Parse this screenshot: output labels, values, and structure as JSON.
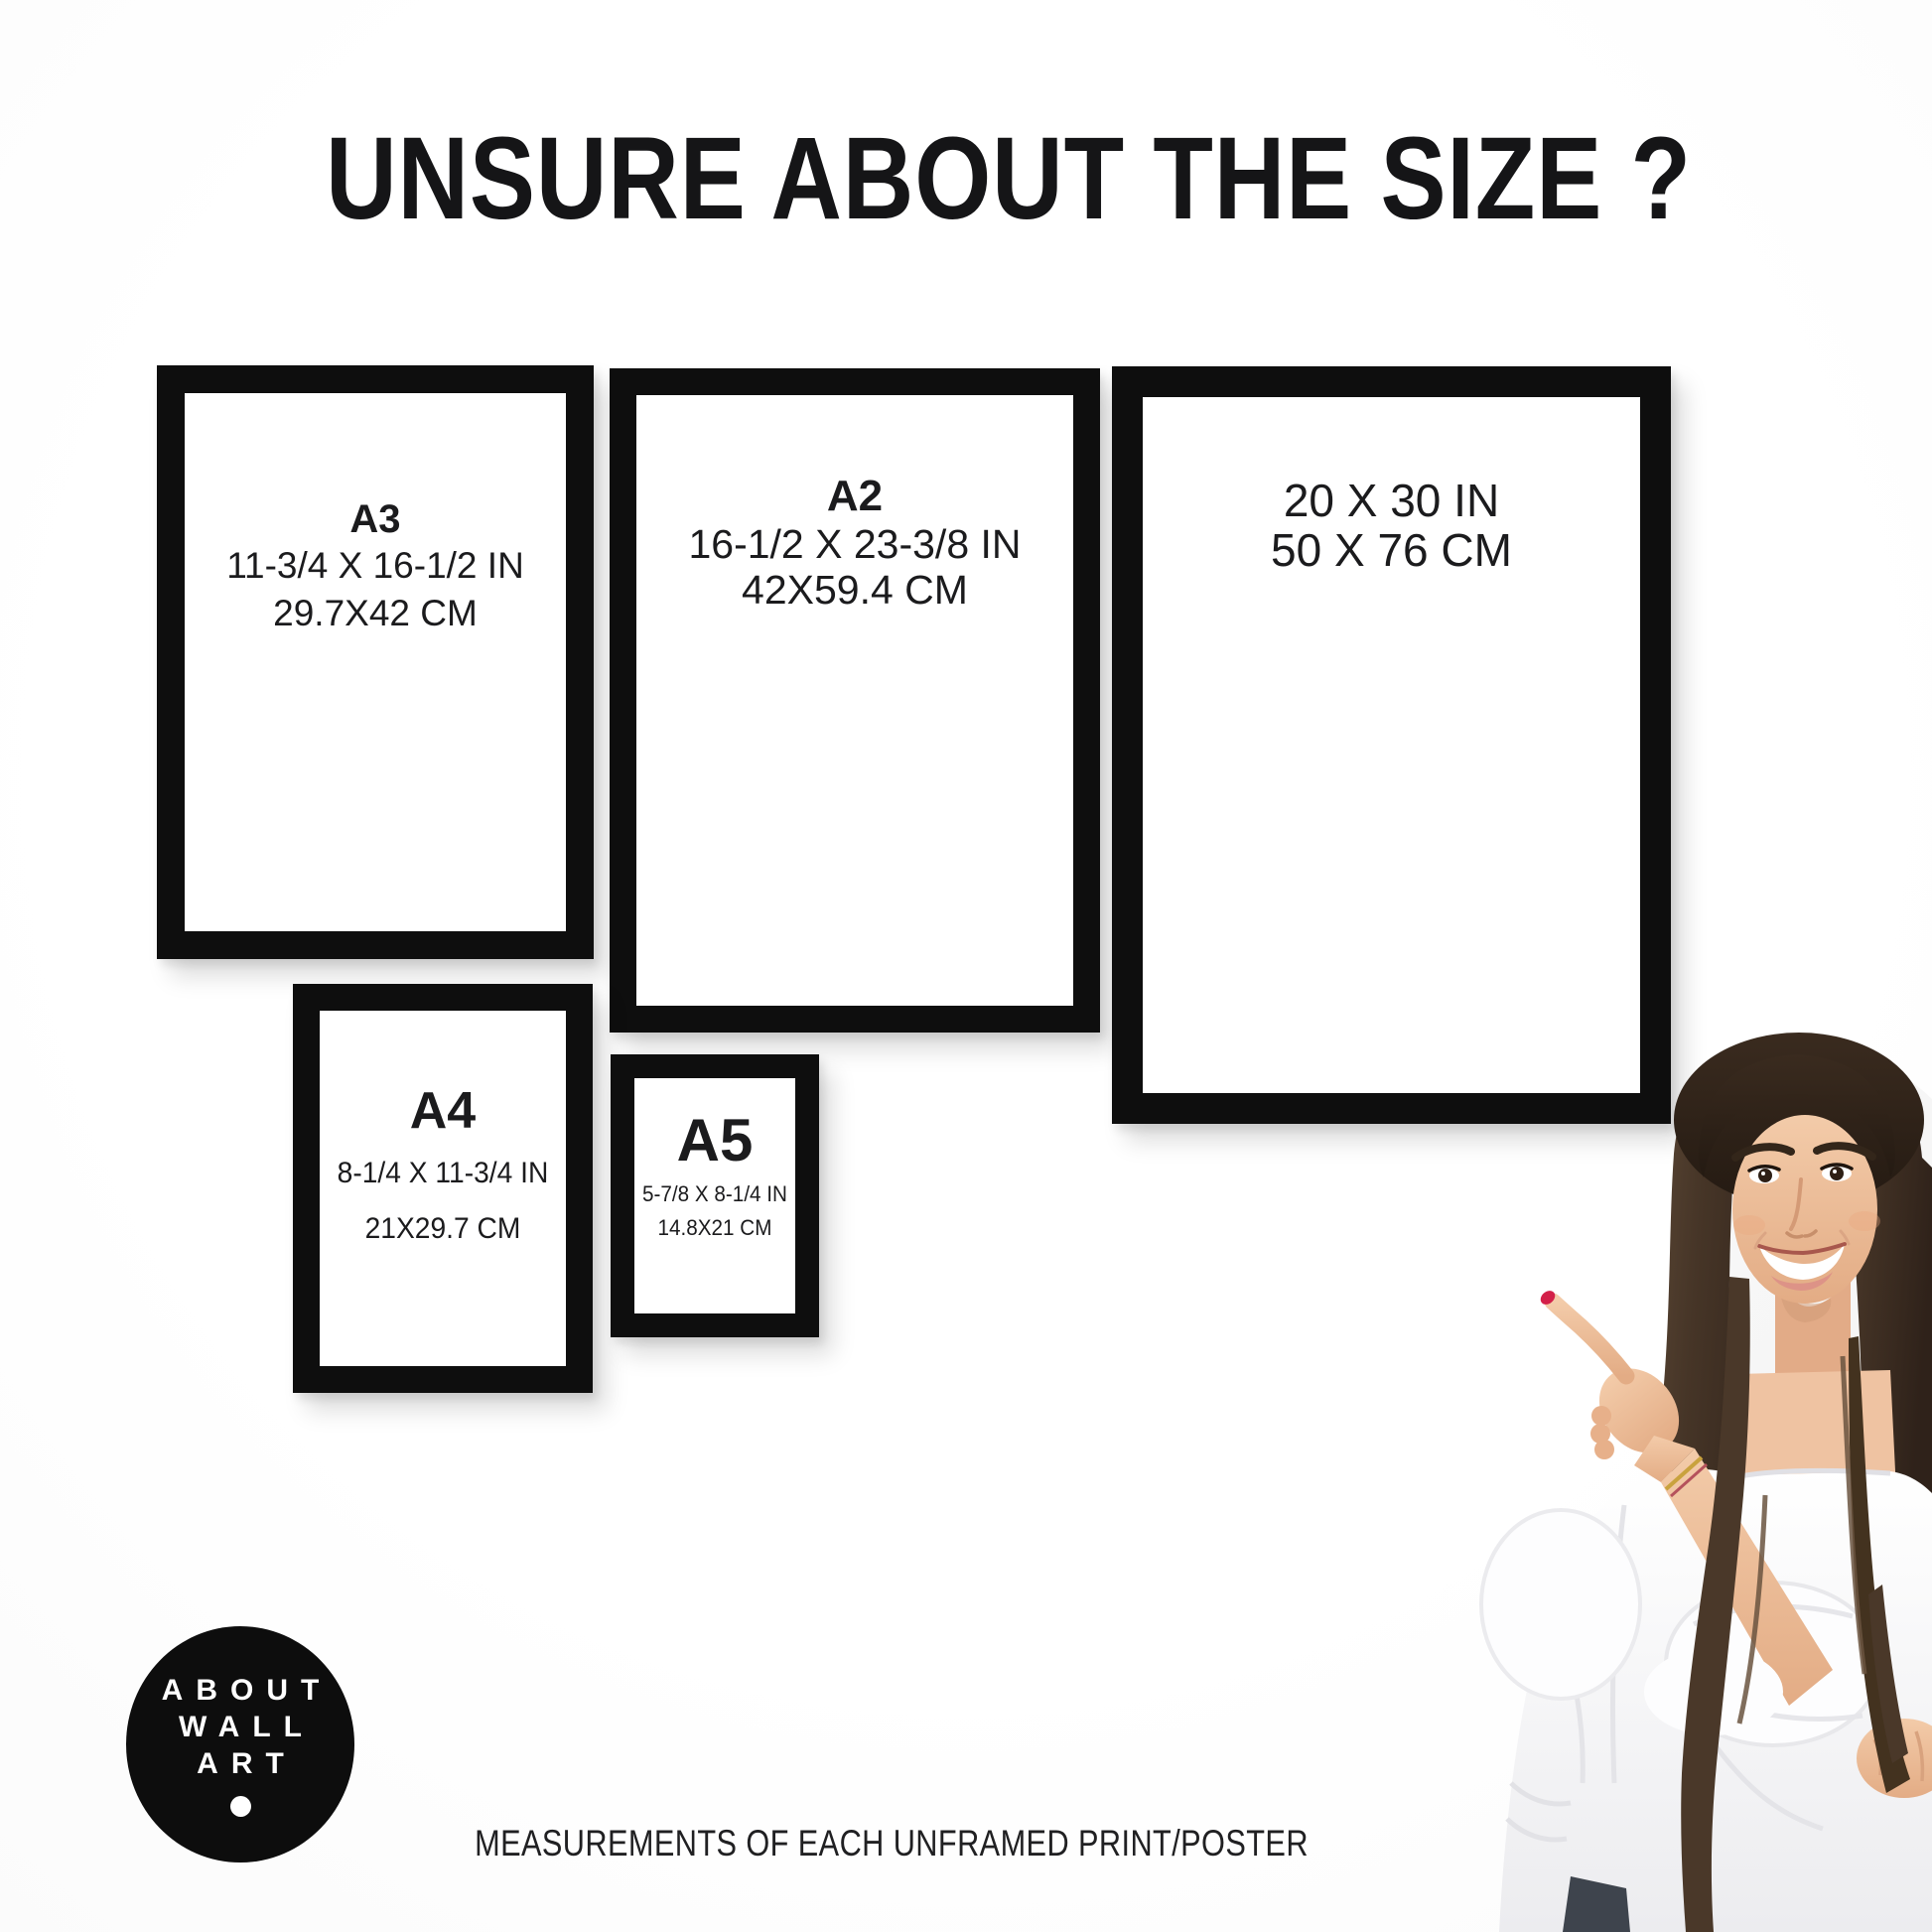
{
  "title": "UNSURE ABOUT THE SIZE ?",
  "caption": "MEASUREMENTS OF EACH UNFRAMED PRINT/POSTER",
  "logo": {
    "lines": [
      "ABOUT",
      "WALL",
      "ART"
    ]
  },
  "frames": [
    {
      "id": "a3",
      "label": "A3",
      "inches": "11-3/4 X 16-1/2 IN",
      "cm": "29.7X42 CM"
    },
    {
      "id": "a2",
      "label": "A2",
      "inches": "16-1/2 X 23-3/8 IN",
      "cm": "42X59.4 CM"
    },
    {
      "id": "20x30",
      "label": "",
      "inches": "20 X 30 IN",
      "cm": "50 X 76 CM"
    },
    {
      "id": "a4",
      "label": "A4",
      "inches": "8-1/4 X 11-3/4 IN",
      "cm": "21X29.7 CM"
    },
    {
      "id": "a5",
      "label": "A5",
      "inches": "5-7/8 X 8-1/4 IN",
      "cm": "14.8X21 CM"
    }
  ],
  "colors": {
    "frame": "#0e0e0e",
    "text": "#1b1b1d",
    "logo_background": "#0d0d0d",
    "logo_text": "#ffffff",
    "nail_polish": "#d32049",
    "background": "#ffffff"
  }
}
